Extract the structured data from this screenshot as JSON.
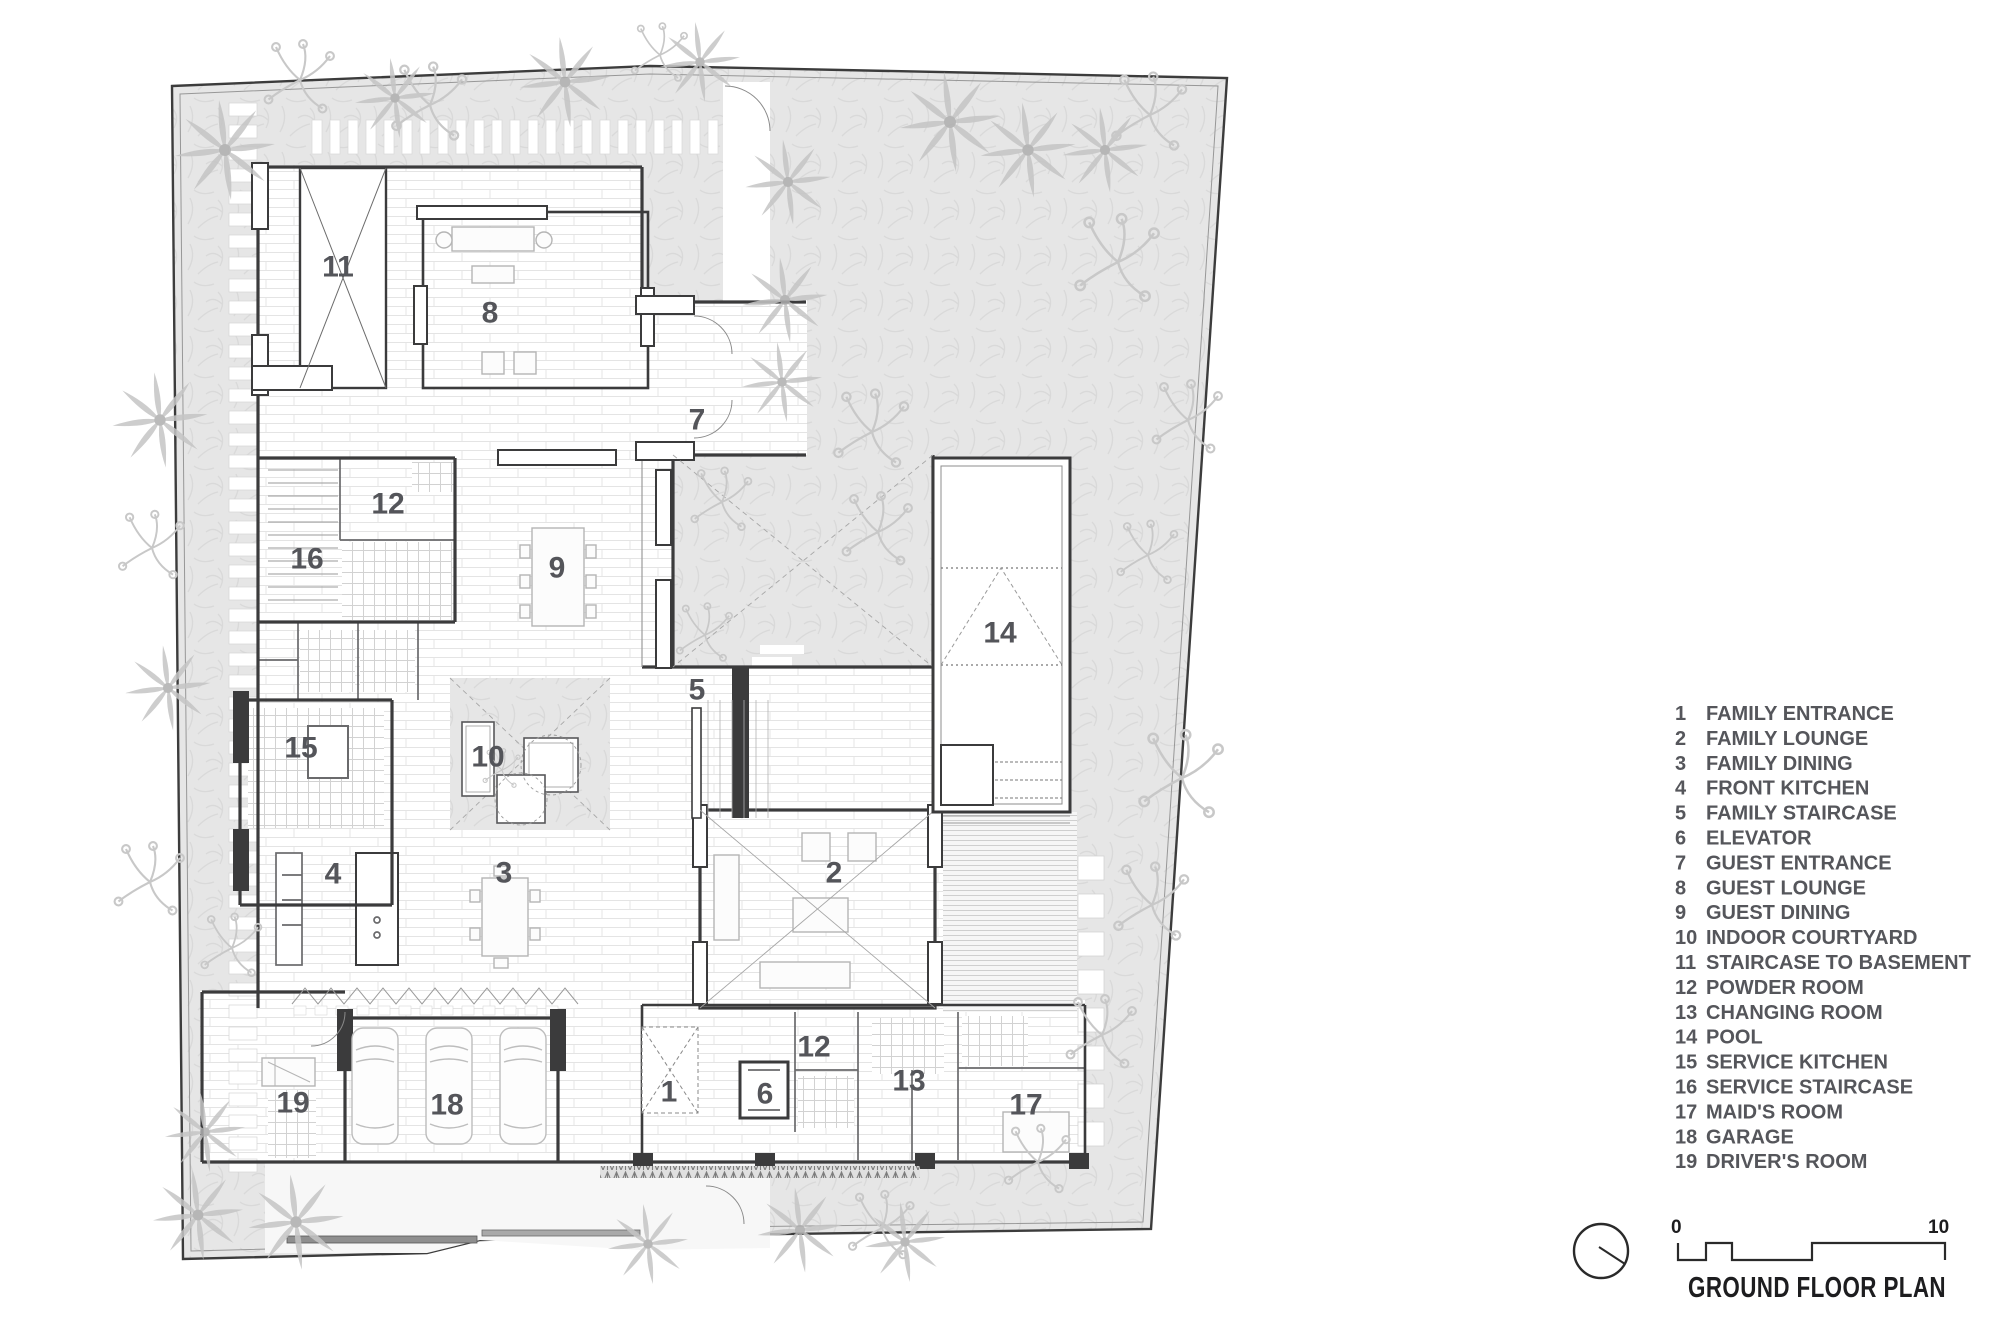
{
  "title_block": {
    "title": "GROUND FLOOR PLAN",
    "scale_bar": {
      "start_label": "0",
      "end_label": "10"
    },
    "north_indicator_icon": "north-indicator"
  },
  "legend": {
    "items": [
      {
        "num": "1",
        "label": "FAMILY ENTRANCE"
      },
      {
        "num": "2",
        "label": "FAMILY LOUNGE"
      },
      {
        "num": "3",
        "label": "FAMILY DINING"
      },
      {
        "num": "4",
        "label": "FRONT KITCHEN"
      },
      {
        "num": "5",
        "label": "FAMILY STAIRCASE"
      },
      {
        "num": "6",
        "label": "ELEVATOR"
      },
      {
        "num": "7",
        "label": "GUEST ENTRANCE"
      },
      {
        "num": "8",
        "label": "GUEST LOUNGE"
      },
      {
        "num": "9",
        "label": "GUEST DINING"
      },
      {
        "num": "10",
        "label": "INDOOR COURTYARD"
      },
      {
        "num": "11",
        "label": "STAIRCASE TO BASEMENT"
      },
      {
        "num": "12",
        "label": "POWDER ROOM"
      },
      {
        "num": "13",
        "label": "CHANGING ROOM"
      },
      {
        "num": "14",
        "label": "POOL"
      },
      {
        "num": "15",
        "label": "SERVICE KITCHEN"
      },
      {
        "num": "16",
        "label": "SERVICE STAIRCASE"
      },
      {
        "num": "17",
        "label": "MAID'S ROOM"
      },
      {
        "num": "18",
        "label": "GARAGE"
      },
      {
        "num": "19",
        "label": "DRIVER'S ROOM"
      }
    ]
  },
  "plan": {
    "room_labels": [
      {
        "num": "1",
        "x": 669,
        "y": 1092
      },
      {
        "num": "2",
        "x": 834,
        "y": 873
      },
      {
        "num": "3",
        "x": 504,
        "y": 873
      },
      {
        "num": "4",
        "x": 333,
        "y": 874
      },
      {
        "num": "5",
        "x": 697,
        "y": 690
      },
      {
        "num": "6",
        "x": 765,
        "y": 1094
      },
      {
        "num": "7",
        "x": 697,
        "y": 420
      },
      {
        "num": "8",
        "x": 490,
        "y": 313
      },
      {
        "num": "9",
        "x": 557,
        "y": 568
      },
      {
        "num": "10",
        "x": 488,
        "y": 757
      },
      {
        "num": "11",
        "x": 338,
        "y": 267
      },
      {
        "num": "12",
        "x": 388,
        "y": 504
      },
      {
        "num": "12",
        "x": 814,
        "y": 1047
      },
      {
        "num": "13",
        "x": 909,
        "y": 1081
      },
      {
        "num": "14",
        "x": 1000,
        "y": 633
      },
      {
        "num": "15",
        "x": 301,
        "y": 748
      },
      {
        "num": "16",
        "x": 307,
        "y": 559
      },
      {
        "num": "17",
        "x": 1026,
        "y": 1105
      },
      {
        "num": "18",
        "x": 447,
        "y": 1105
      },
      {
        "num": "19",
        "x": 293,
        "y": 1103
      }
    ]
  },
  "landscape": {
    "palm_icon": "palm-tree-icon",
    "tree_icon": "shrub-branch-icon",
    "palms": [
      {
        "x": 225,
        "y": 150,
        "s": 2.0
      },
      {
        "x": 395,
        "y": 98,
        "s": 1.6
      },
      {
        "x": 565,
        "y": 82,
        "s": 1.8
      },
      {
        "x": 700,
        "y": 62,
        "s": 1.6
      },
      {
        "x": 788,
        "y": 182,
        "s": 1.7
      },
      {
        "x": 785,
        "y": 300,
        "s": 1.7
      },
      {
        "x": 782,
        "y": 382,
        "s": 1.6
      },
      {
        "x": 950,
        "y": 122,
        "s": 2.0
      },
      {
        "x": 1028,
        "y": 150,
        "s": 1.9
      },
      {
        "x": 1105,
        "y": 150,
        "s": 1.7
      },
      {
        "x": 160,
        "y": 420,
        "s": 1.9
      },
      {
        "x": 168,
        "y": 688,
        "s": 1.7
      },
      {
        "x": 205,
        "y": 1132,
        "s": 1.6
      },
      {
        "x": 198,
        "y": 1215,
        "s": 1.8
      },
      {
        "x": 296,
        "y": 1222,
        "s": 1.9
      },
      {
        "x": 648,
        "y": 1244,
        "s": 1.6
      },
      {
        "x": 800,
        "y": 1230,
        "s": 1.7
      },
      {
        "x": 905,
        "y": 1242,
        "s": 1.6
      }
    ],
    "trees": [
      {
        "x": 300,
        "y": 80,
        "s": 1.5
      },
      {
        "x": 430,
        "y": 105,
        "s": 1.6
      },
      {
        "x": 660,
        "y": 55,
        "s": 1.2
      },
      {
        "x": 1150,
        "y": 115,
        "s": 1.6
      },
      {
        "x": 1118,
        "y": 262,
        "s": 1.8
      },
      {
        "x": 1188,
        "y": 420,
        "s": 1.5
      },
      {
        "x": 1148,
        "y": 555,
        "s": 1.3
      },
      {
        "x": 872,
        "y": 432,
        "s": 1.6
      },
      {
        "x": 1182,
        "y": 778,
        "s": 1.8
      },
      {
        "x": 1152,
        "y": 905,
        "s": 1.6
      },
      {
        "x": 1102,
        "y": 1035,
        "s": 1.5
      },
      {
        "x": 1038,
        "y": 1162,
        "s": 1.4
      },
      {
        "x": 882,
        "y": 1228,
        "s": 1.4
      },
      {
        "x": 722,
        "y": 502,
        "s": 1.3
      },
      {
        "x": 878,
        "y": 532,
        "s": 1.5
      },
      {
        "x": 705,
        "y": 635,
        "s": 1.2
      },
      {
        "x": 152,
        "y": 548,
        "s": 1.4
      },
      {
        "x": 150,
        "y": 882,
        "s": 1.5
      },
      {
        "x": 232,
        "y": 948,
        "s": 1.3
      },
      {
        "x": 502,
        "y": 770,
        "s": 0.8
      }
    ]
  },
  "colors": {
    "wall": "#3b3b3c",
    "partition": "#6a6a6c",
    "grass": "#e6e6e6",
    "grass_stroke": "#d9d9d9",
    "room_label": "#54555a",
    "legend_text": "#55565b",
    "title_text": "#1d1d1f",
    "furniture": "#b5b5b5"
  }
}
